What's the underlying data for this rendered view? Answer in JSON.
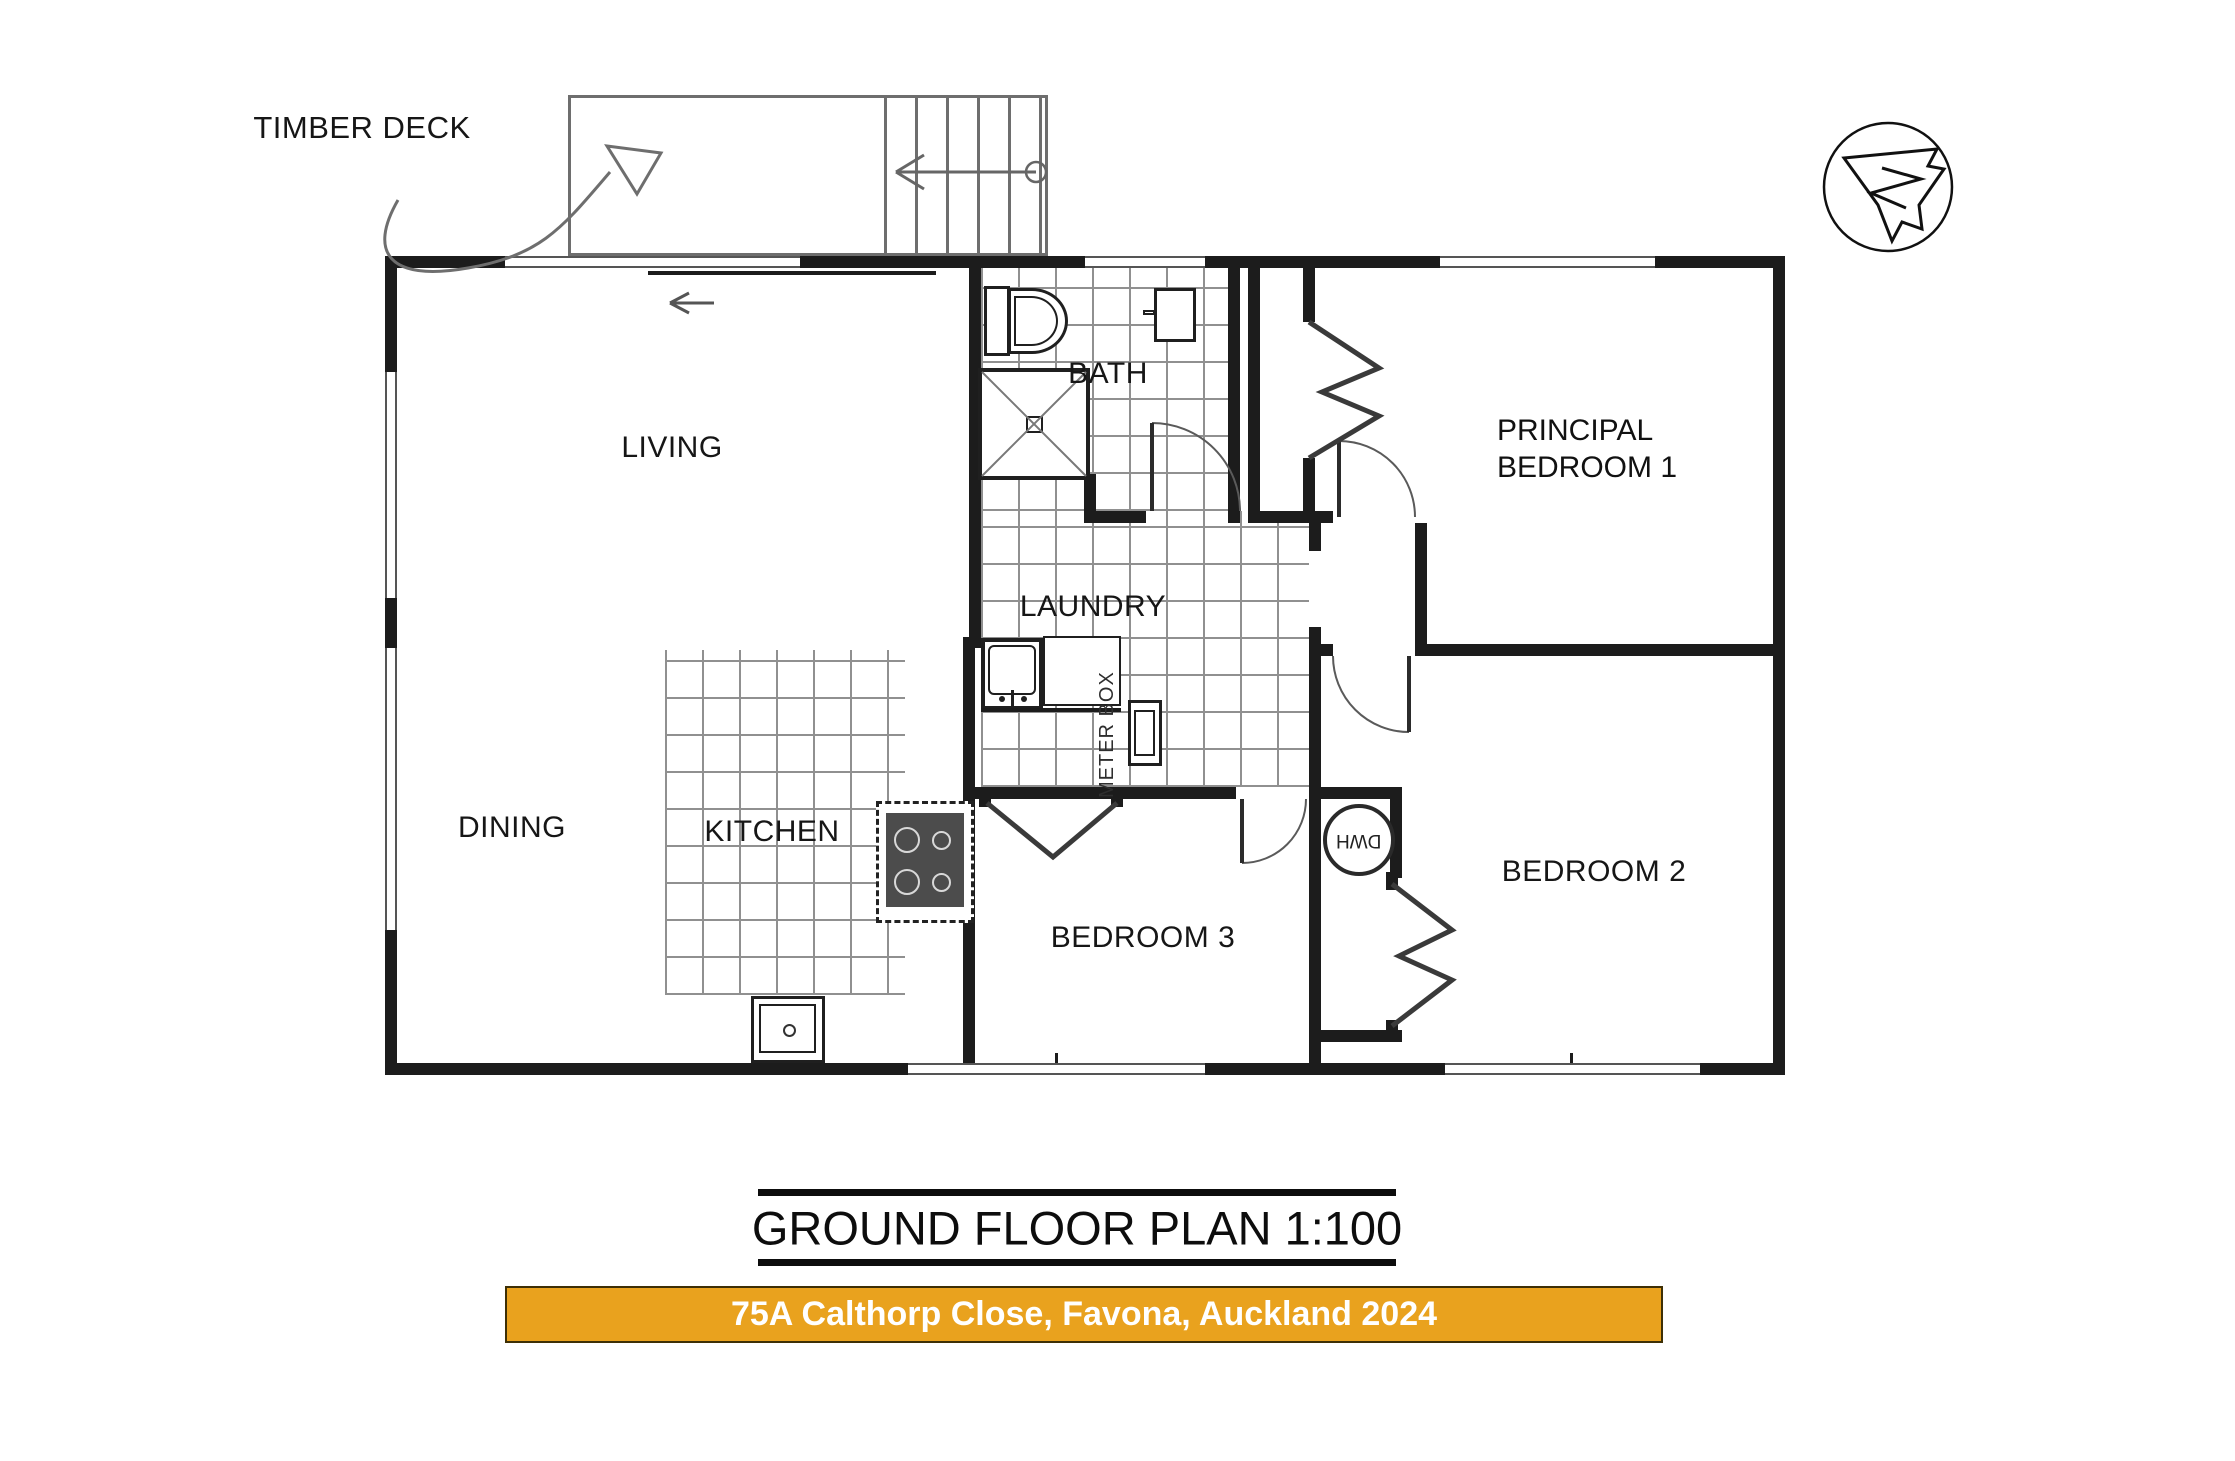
{
  "annotations": {
    "deck_label": "TIMBER DECK"
  },
  "rooms": {
    "living": "LIVING",
    "dining": "DINING",
    "kitchen": "KITCHEN",
    "bath": "BATH",
    "laundry": "LAUNDRY",
    "principal_line1": "PRINCIPAL",
    "principal_line2": "BEDROOM 1",
    "bedroom2": "BEDROOM 2",
    "bedroom3": "BEDROOM 3"
  },
  "fixtures": {
    "hot_water_cylinder": "DWH",
    "meter_box": "METER BOX"
  },
  "title": {
    "text": "GROUND FLOOR PLAN 1:100"
  },
  "banner": {
    "text": "75A Calthorp Close, Favona, Auckland 2024",
    "background": "#E9A21E",
    "text_color": "#ffffff",
    "border_color": "#3d2f05"
  },
  "icons": {
    "north_compass": "north-compass-icon",
    "stair_direction": "stair-direction-arrow",
    "deck_pointer": "deck-pointer-triangle",
    "entry_direction": "sliding-door-arrow"
  },
  "drawing": {
    "wall_color": "#1c1c1c",
    "tile_line_color": "#909090",
    "scale": "1:100"
  }
}
